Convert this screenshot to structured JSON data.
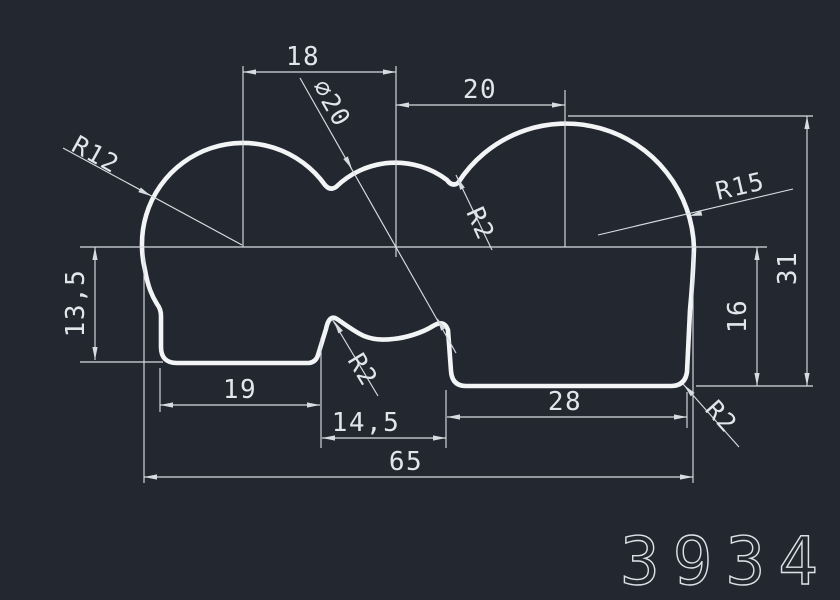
{
  "canvas": {
    "background_color": "#232730",
    "profile_color": "#f2f4f6",
    "dimension_color": "#d8dce1"
  },
  "labels": {
    "dim_18": "18",
    "dim_dia20": "∅20",
    "dim_20": "20",
    "radius_r12": "R12",
    "radius_r15": "R15",
    "radius_r2_mid": "R2",
    "radius_r2_notch": "R2",
    "radius_r2_corner": "R2",
    "dim_13_5": "13,5",
    "dim_19": "19",
    "dim_14_5": "14,5",
    "dim_28": "28",
    "dim_65": "65",
    "dim_16": "16",
    "dim_31": "31",
    "part_number": "3934"
  }
}
